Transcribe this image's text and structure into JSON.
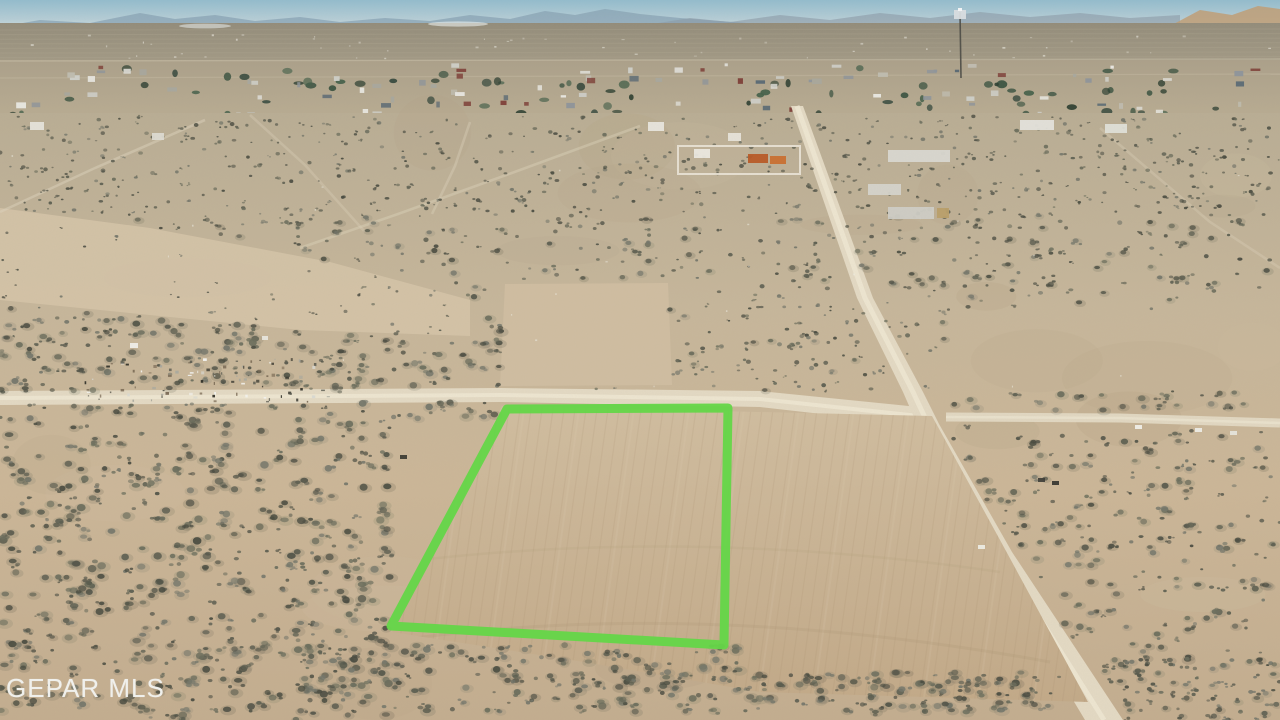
{
  "image": {
    "kind": "aerial-drone-real-estate-photo",
    "description": "Aerial view of a vacant graded desert lot outlined in green beside dirt roads, with a small desert town and hazy mountains on the horizon",
    "watermark": "GEPAR MLS"
  },
  "colors": {
    "sky_top": "#93bccd",
    "sky_horizon": "#d3dfe0",
    "mountains_blue": "#88a3b4",
    "hills_tan": "#bf9d76",
    "plain_far": "#938c7a",
    "plain_near": "#a59c87",
    "town_base": "#b2a68c",
    "desert_top": "#b9ad94",
    "desert_mid": "#c6b69a",
    "desert_low": "#c3ad8f",
    "sand_wash": "#d4c3a7",
    "cleared_pad": "#cfbda1",
    "road_fill": "#e3d9c3",
    "road_center": "#efe7d3",
    "graded_top": "#d0bd9f",
    "graded_bottom": "#c2a988",
    "scrub_dark": "#54564a",
    "boundary_green": "#64d648",
    "watermark_color": "#f0f0ec"
  },
  "property_outline": {
    "stroke_width": 9,
    "points": [
      [
        507,
        409
      ],
      [
        728,
        408
      ],
      [
        724,
        645
      ],
      [
        391,
        626
      ]
    ]
  },
  "roads": {
    "main_road_center": [
      [
        797,
        106
      ],
      [
        865,
        298
      ],
      [
        913,
        392
      ],
      [
        928,
        424
      ],
      [
        998,
        552
      ],
      [
        1104,
        720
      ]
    ],
    "main_road_halfwidth": [
      6,
      8,
      10,
      11,
      14,
      19
    ],
    "cross_road_center": [
      [
        0,
        398
      ],
      [
        500,
        395
      ],
      [
        760,
        399
      ],
      [
        928,
        417
      ]
    ],
    "cross_road_halfheight": [
      7,
      7,
      8,
      9
    ],
    "east_road": [
      [
        946,
        417
      ],
      [
        1120,
        418
      ],
      [
        1280,
        423
      ]
    ]
  },
  "landmarks": {
    "graded_area": [
      [
        502,
        406
      ],
      [
        932,
        416
      ],
      [
        1000,
        540
      ],
      [
        1088,
        702
      ],
      [
        760,
        692
      ],
      [
        584,
        662
      ],
      [
        392,
        632
      ]
    ],
    "cleared_pad": [
      [
        505,
        284
      ],
      [
        668,
        283
      ],
      [
        672,
        385
      ],
      [
        500,
        386
      ]
    ],
    "sand_wash": [
      [
        0,
        208
      ],
      [
        150,
        228
      ],
      [
        330,
        262
      ],
      [
        470,
        300
      ],
      [
        470,
        336
      ],
      [
        300,
        330
      ],
      [
        120,
        312
      ],
      [
        0,
        300
      ]
    ],
    "debris_field": {
      "x": 80,
      "y": 358,
      "width": 250,
      "height": 44
    },
    "radio_tower": {
      "x": 960,
      "y_top": 12,
      "y_base": 78
    },
    "structures": [
      {
        "x": 678,
        "y": 146,
        "w": 122,
        "h": 28,
        "c": "#cdbfa6"
      },
      {
        "x": 748,
        "y": 154,
        "w": 20,
        "h": 9,
        "c": "#b85a26"
      },
      {
        "x": 770,
        "y": 156,
        "w": 16,
        "h": 8,
        "c": "#c96f2f"
      },
      {
        "x": 694,
        "y": 149,
        "w": 16,
        "h": 9,
        "c": "#ece9e0"
      },
      {
        "x": 728,
        "y": 133,
        "w": 13,
        "h": 8,
        "c": "#e7e4da"
      },
      {
        "x": 888,
        "y": 150,
        "w": 62,
        "h": 12,
        "c": "#d9d8d1"
      },
      {
        "x": 868,
        "y": 184,
        "w": 33,
        "h": 11,
        "c": "#d5d4cb"
      },
      {
        "x": 888,
        "y": 207,
        "w": 46,
        "h": 12,
        "c": "#cfcec6"
      },
      {
        "x": 937,
        "y": 208,
        "w": 12,
        "h": 10,
        "c": "#b99f69"
      },
      {
        "x": 1020,
        "y": 120,
        "w": 34,
        "h": 10,
        "c": "#e4e3dc"
      },
      {
        "x": 1105,
        "y": 124,
        "w": 22,
        "h": 9,
        "c": "#dfe0d8"
      },
      {
        "x": 648,
        "y": 122,
        "w": 16,
        "h": 9,
        "c": "#e8e6de"
      },
      {
        "x": 30,
        "y": 122,
        "w": 14,
        "h": 8,
        "c": "#e6e4db"
      },
      {
        "x": 152,
        "y": 133,
        "w": 12,
        "h": 7,
        "c": "#dddbd2"
      }
    ]
  }
}
